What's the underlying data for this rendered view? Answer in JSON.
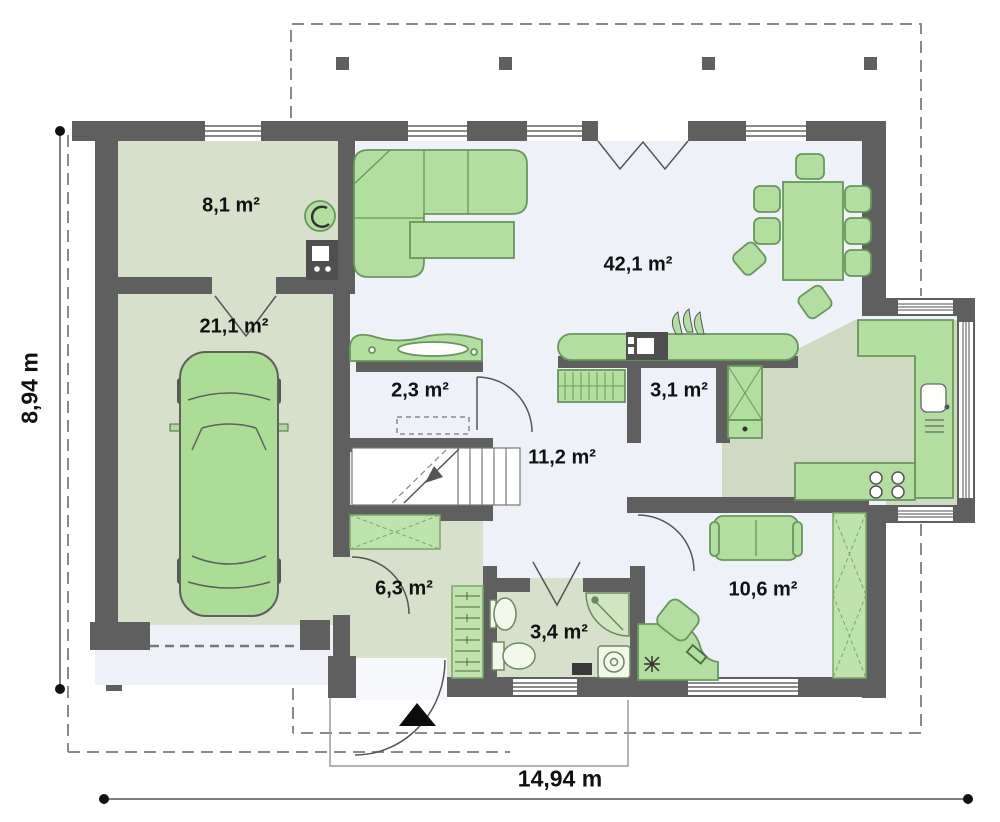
{
  "plan": {
    "type": "house-floor-plan",
    "rooms": [
      {
        "key": "utility-room",
        "area": "8,1 m²"
      },
      {
        "key": "garage",
        "area": "21,1 m²"
      },
      {
        "key": "living-dining",
        "area": "42,1 m²"
      },
      {
        "key": "closet",
        "area": "2,3 m²"
      },
      {
        "key": "pantry",
        "area": "3,1 m²"
      },
      {
        "key": "hall",
        "area": "11,2 m²"
      },
      {
        "key": "entry-hall",
        "area": "6,3 m²"
      },
      {
        "key": "bathroom",
        "area": "3,4 m²"
      },
      {
        "key": "bedroom",
        "area": "10,6 m²"
      }
    ],
    "dimensions": {
      "overall_width": "14,94 m",
      "overall_depth": "8,94 m"
    },
    "colors": {
      "wall": "#5f5f5f",
      "floor_light": "#eef2f8",
      "floor_green": "#d6e0ca",
      "furniture_fill": "#b2dfa0",
      "furniture_stroke": "#67975a",
      "dash_line": "#8a8a8a"
    }
  }
}
